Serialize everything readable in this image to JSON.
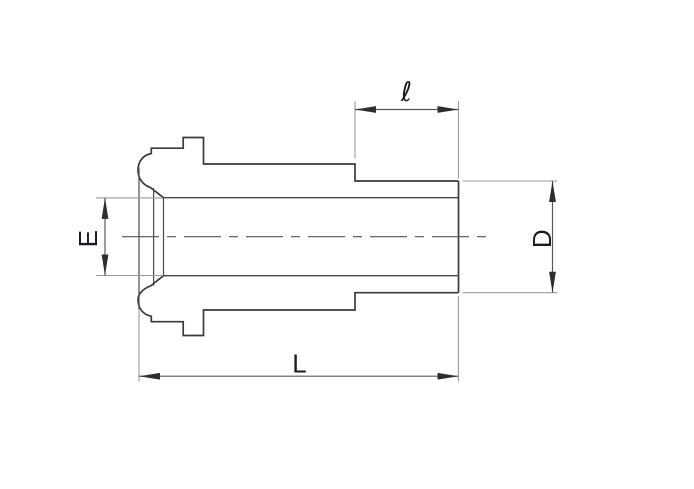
{
  "drawing": {
    "type": "technical-dimension-drawing",
    "description": "Cross-section outline of a tube fitting gland with four dimension callouts",
    "labels": {
      "stub_length": "ℓ",
      "inner_diameter": "E",
      "outer_diameter": "D",
      "overall_length": "L"
    },
    "colors": {
      "background": "#ffffff",
      "part_outline": "#3a3a3a",
      "dimension_line": "#5a5a5a",
      "extension_line": "#9b9b9b",
      "label_text": "#1b1b24"
    }
  }
}
